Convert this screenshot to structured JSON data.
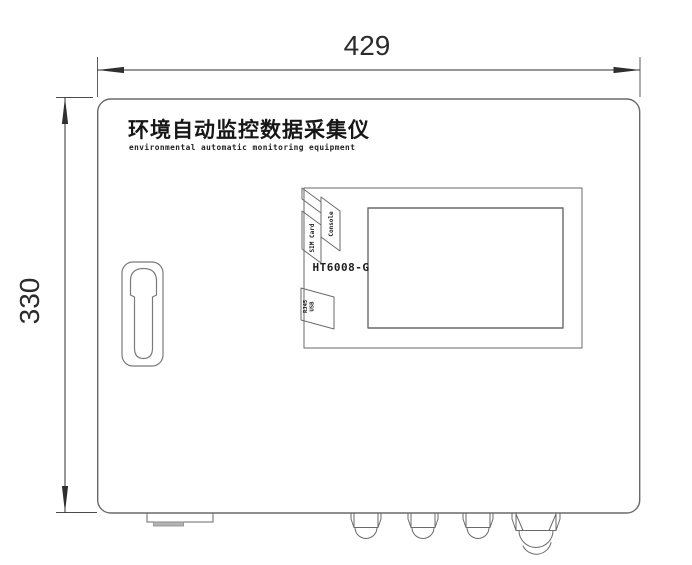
{
  "drawing": {
    "dim_width": "429",
    "dim_height": "330",
    "title_cn": "环境自动监控数据采集仪",
    "title_en": "environmental automatic monitoring equipment",
    "model": "HT6008-G",
    "ports": {
      "console": "Console",
      "sim_card": "SIM Card",
      "rj45": "RJ45",
      "usb": "USB"
    },
    "colors": {
      "outline": "#6a6a6a",
      "dimension": "#2f2f2f",
      "text": "#1d1d1d",
      "bracket_fill": "#b3b3b3"
    }
  }
}
